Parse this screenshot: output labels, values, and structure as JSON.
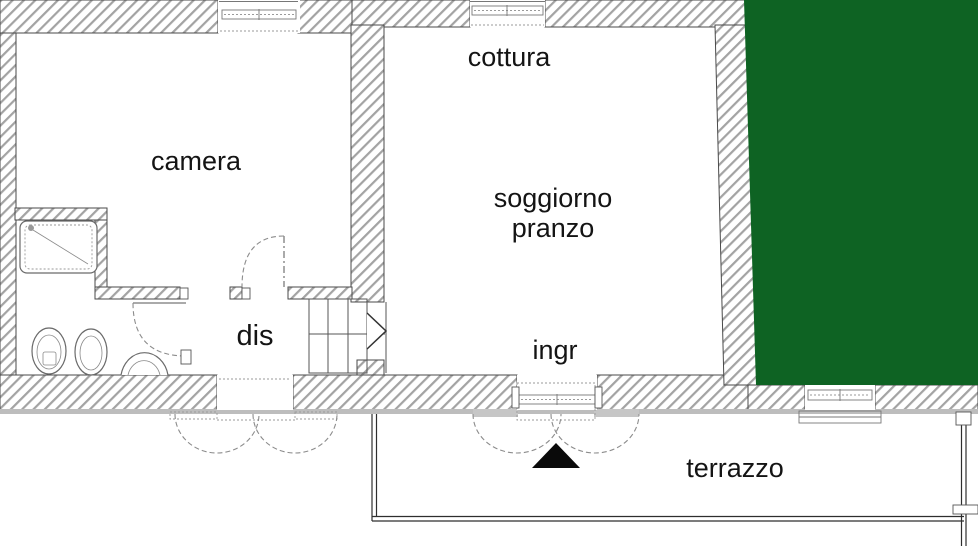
{
  "floor_plan": {
    "labels": {
      "camera": "camera",
      "cottura": "cottura",
      "soggiorno_line1": "soggiorno",
      "soggiorno_line2": "pranzo",
      "ingresso": "ingr",
      "disimpegno": "dis",
      "terrazzo": "terrazzo"
    },
    "colors": {
      "garden": "#0e6323",
      "hatch": "#a3a3a3",
      "plaster": "#bdbdbd"
    }
  }
}
